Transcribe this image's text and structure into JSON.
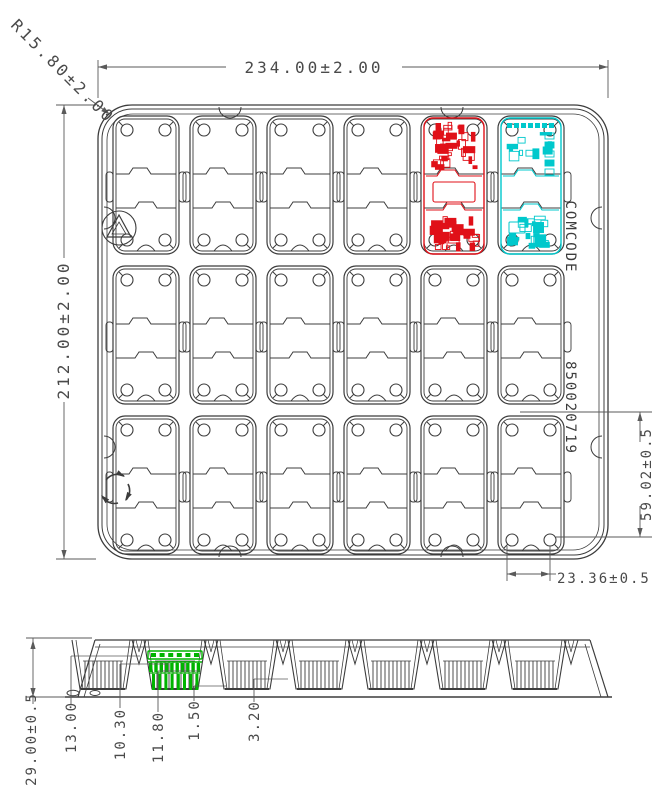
{
  "drawing": {
    "type": "technical-drawing-packaging-tray",
    "colors": {
      "line": "#3c3c3c",
      "dim_line": "#5a5a5a",
      "pcb_red": "#e01018",
      "pcb_cyan": "#00c8cc",
      "part_green": "#00b400",
      "background": "#ffffff"
    },
    "top_view": {
      "width_dim": "234.00±2.00",
      "height_dim": "212.00±2.00",
      "corner_radius_dim": "R15.80±2.00",
      "pocket_pitch_dim": "59.02±0.5",
      "pocket_width_dim": "23.36±0.5",
      "side_text_line1": "COMCODE",
      "side_text_line2": "850020719",
      "grid": {
        "columns": 6,
        "rows": 3
      },
      "highlighted_pockets": [
        {
          "row": 1,
          "column": 5,
          "color": "#e01018",
          "name": "pcb-red"
        },
        {
          "row": 1,
          "column": 6,
          "color": "#00c8cc",
          "name": "pcb-cyan"
        }
      ],
      "icons": [
        "recycle-triangle-icon",
        "recycle-arrows-icon"
      ]
    },
    "side_view": {
      "overall_height_dim": "29.00±0.5",
      "step_dims": [
        "13.00",
        "10.30",
        "11.80",
        "1.50",
        "3.20"
      ],
      "highlighted_part": {
        "color": "#00b400",
        "name": "green-component"
      }
    }
  }
}
